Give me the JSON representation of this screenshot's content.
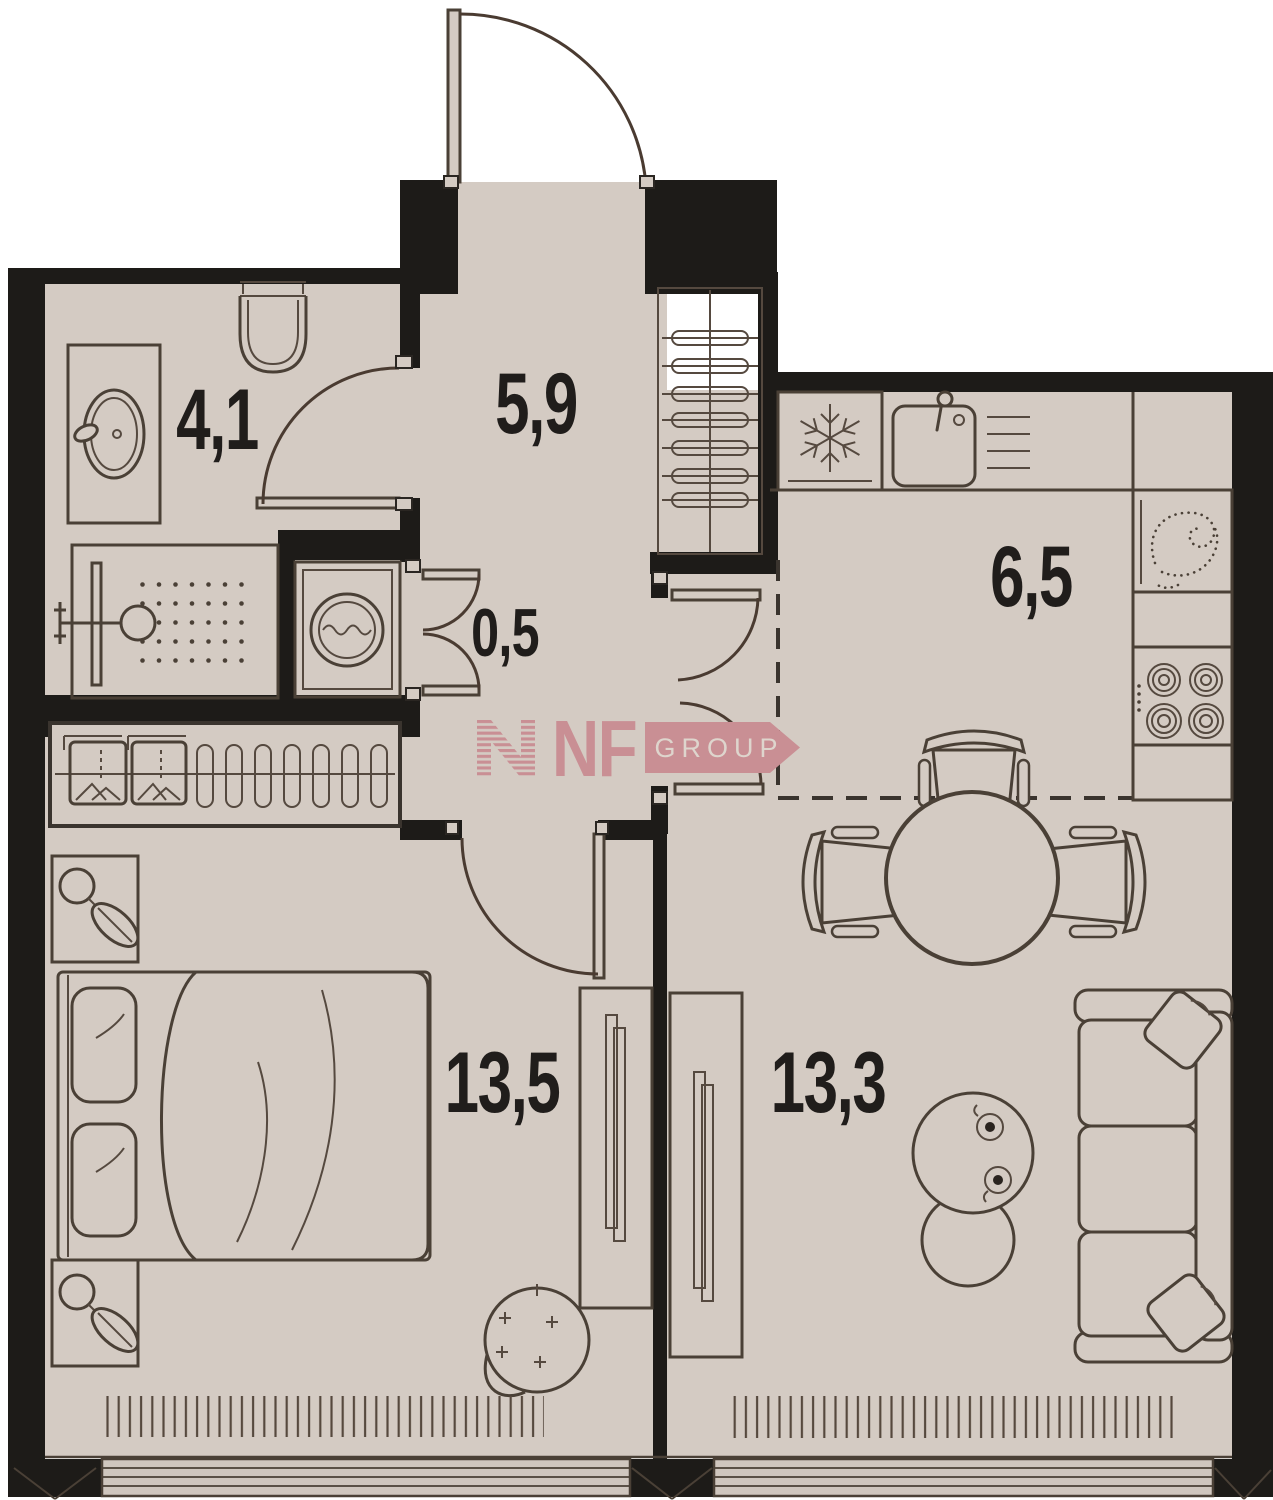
{
  "title": "apartment-floor-plan",
  "rooms": {
    "bathroom": {
      "name": "bathroom",
      "label": "4,1"
    },
    "hallway": {
      "name": "hallway",
      "label": "5,9"
    },
    "storage": {
      "name": "storage",
      "label": "0,5"
    },
    "kitchen": {
      "name": "kitchen",
      "label": "6,5"
    },
    "bedroom": {
      "name": "bedroom",
      "label": "13,5"
    },
    "living_room": {
      "name": "living-room",
      "label": "13,3"
    }
  },
  "logo": {
    "brand": "NF GROUP",
    "nf": "NF",
    "group": "GROUP"
  },
  "colors": {
    "background": "#ffffff",
    "floor": "#d4cbc3",
    "walls": "#1d1b18",
    "furniture_line": "#4a4036",
    "logo_accent": "#c98f94",
    "logo_text_light": "#ded5cd",
    "label_text": "#201d1b"
  },
  "fixtures": [
    "toilet-icon",
    "basin-icon",
    "shower-icon",
    "washing-machine-icon",
    "fridge-snowflake-icon",
    "kitchen-sink-icon",
    "dish-rack-icon",
    "oven-icon",
    "hob-icon",
    "hanger-icon",
    "folded-clothes-icon",
    "double-bed",
    "pillow-icon",
    "nightstand-lamp-icon",
    "wardrobe",
    "dining-table",
    "chair",
    "sofa",
    "coffee-table",
    "plant-icon",
    "radiator",
    "window",
    "door-swing"
  ]
}
